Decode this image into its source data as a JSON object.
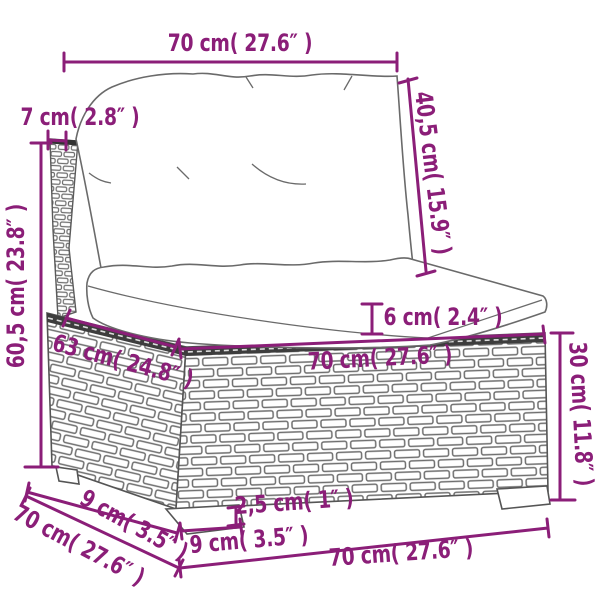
{
  "diagram": {
    "dimensions": {
      "top_width": {
        "label": "70 cm( 27.6″ )"
      },
      "back_thickness": {
        "label": "7 cm( 2.8″ )"
      },
      "back_cushion_height": {
        "label": "40,5 cm( 15.9″ )"
      },
      "total_height": {
        "label": "60,5 cm( 23.8″ )"
      },
      "seat_cushion_thickness": {
        "label": "6 cm( 2.4″ )"
      },
      "seat_depth": {
        "label": "63 cm( 24.8″ )"
      },
      "seat_width": {
        "label": "70 cm( 27.6″ )"
      },
      "base_height": {
        "label": "30 cm( 11.8″ )"
      },
      "leg_depth": {
        "label": "9 cm( 3.5″ )"
      },
      "total_depth": {
        "label": "70 cm( 27.6″ )"
      },
      "foot_height": {
        "label": "2,5 cm( 1″ )"
      },
      "leg_width": {
        "label": "9 cm( 3.5″ )"
      },
      "bottom_width": {
        "label": "70 cm( 27.6″ )"
      }
    },
    "colors": {
      "dimension_annotation": "#8B1E78",
      "line_art_outline": "#6A6A6A",
      "wicker_top_band": "#3D3D3D",
      "background": "#FFFFFF"
    }
  }
}
